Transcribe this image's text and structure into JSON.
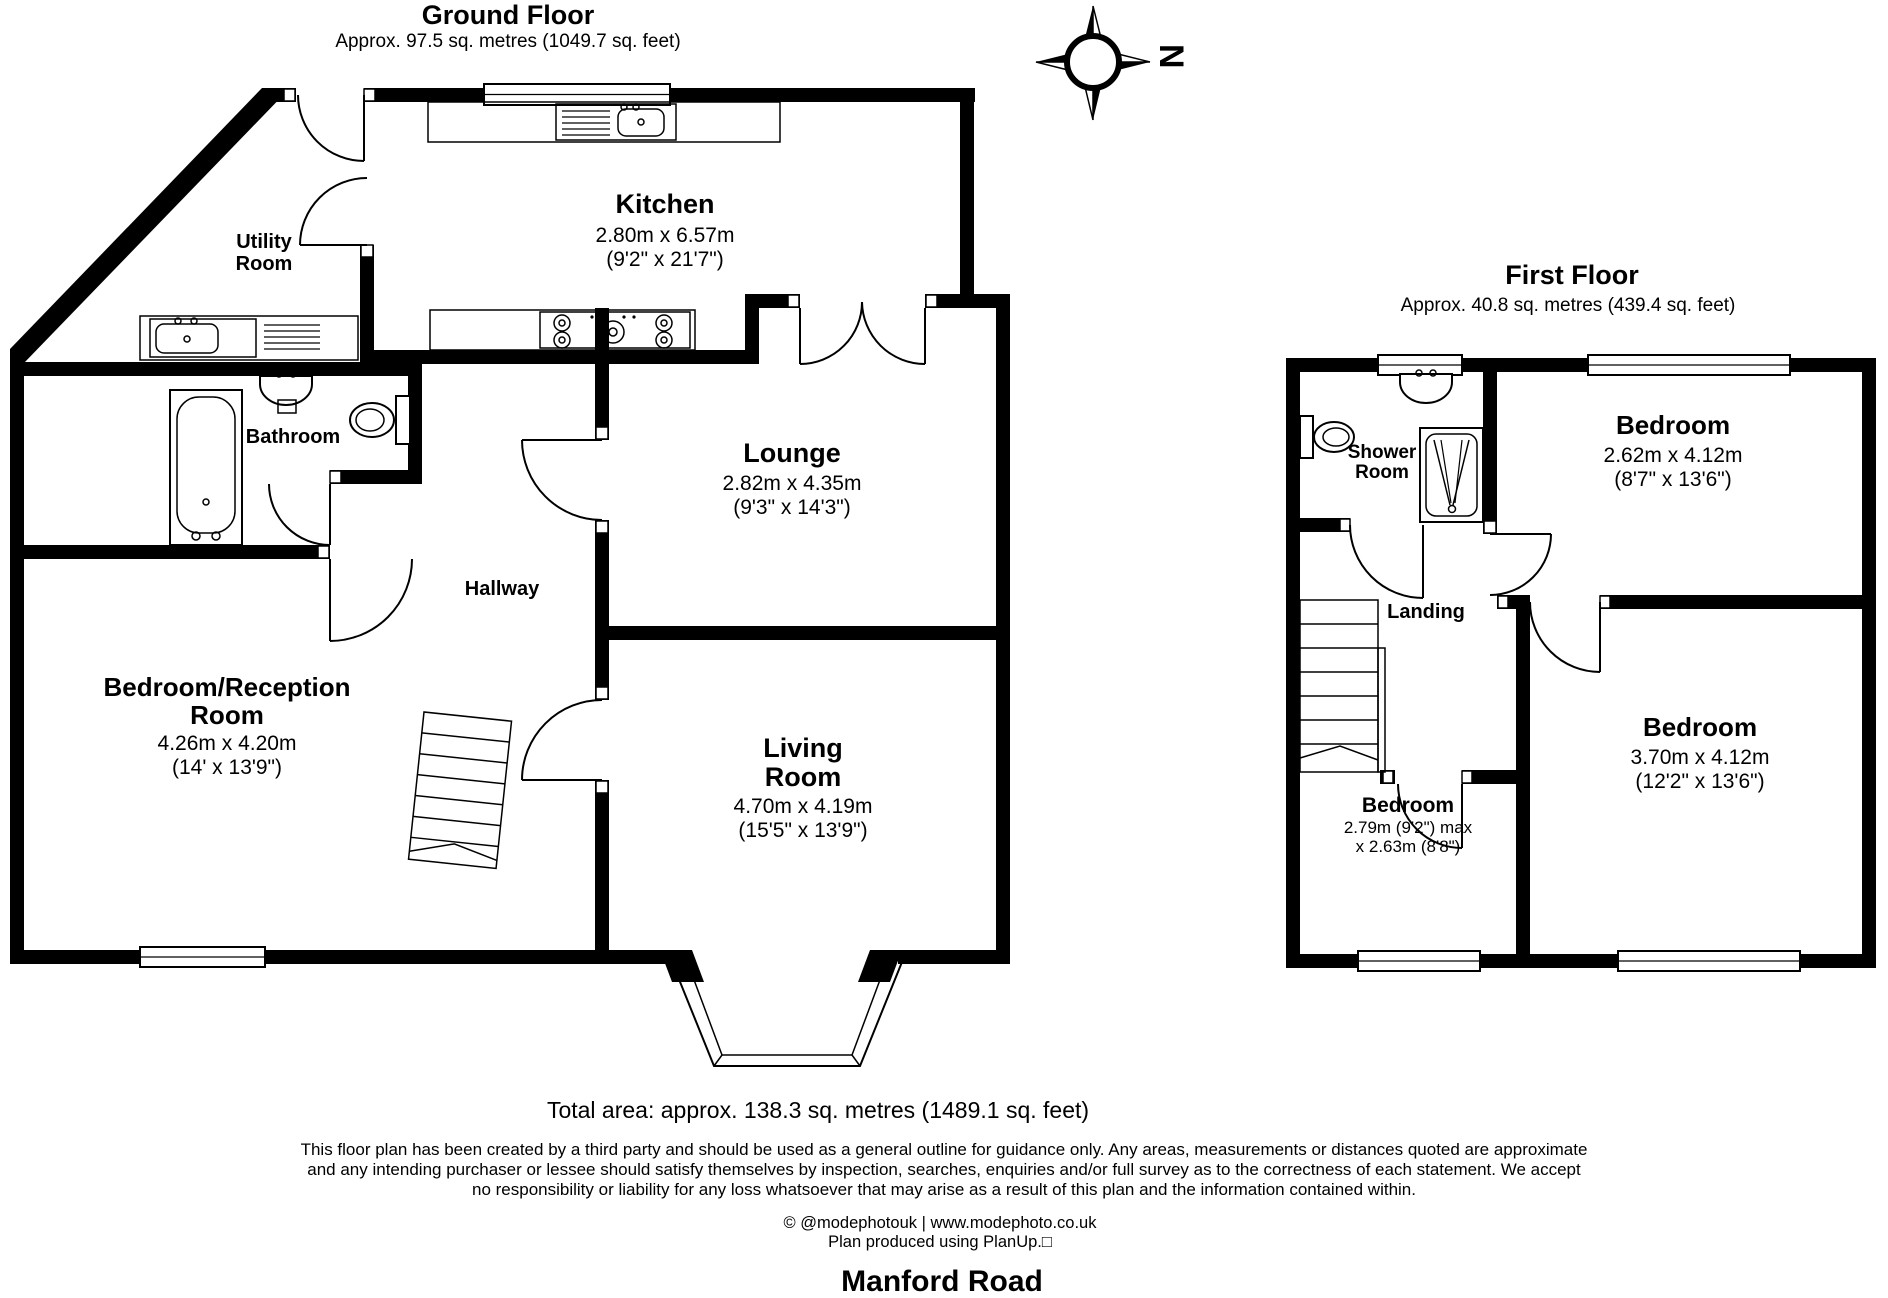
{
  "ground_floor": {
    "title": "Ground Floor",
    "subtitle": "Approx. 97.5 sq. metres (1049.7 sq. feet)",
    "rooms": {
      "kitchen": {
        "name": "Kitchen",
        "metric": "2.80m x 6.57m",
        "imperial": "(9'2\" x 21'7\")"
      },
      "utility": {
        "line1": "Utility",
        "line2": "Room"
      },
      "bathroom": {
        "name": "Bathroom"
      },
      "hallway": {
        "name": "Hallway"
      },
      "lounge": {
        "name": "Lounge",
        "metric": "2.82m x 4.35m",
        "imperial": "(9'3\" x 14'3\")"
      },
      "bedroom_reception": {
        "line1": "Bedroom/Reception",
        "line2": "Room",
        "metric": "4.26m x 4.20m",
        "imperial": "(14' x 13'9\")"
      },
      "living_room": {
        "line1": "Living",
        "line2": "Room",
        "metric": "4.70m x 4.19m",
        "imperial": "(15'5\" x 13'9\")"
      }
    }
  },
  "first_floor": {
    "title": "First Floor",
    "subtitle": "Approx. 40.8 sq. metres (439.4 sq. feet)",
    "rooms": {
      "shower_room": {
        "line1": "Shower",
        "line2": "Room"
      },
      "landing": {
        "name": "Landing"
      },
      "bedroom_front": {
        "name": "Bedroom",
        "metric": "2.62m x 4.12m",
        "imperial": "(8'7\" x 13'6\")"
      },
      "bedroom_small": {
        "name": "Bedroom",
        "dims1": "2.79m (9'2\") max",
        "dims2": "x 2.63m (8'8\")"
      },
      "bedroom_rear": {
        "name": "Bedroom",
        "metric": "3.70m x 4.12m",
        "imperial": "(12'2\" x 13'6\")"
      }
    }
  },
  "compass": {
    "north_label": "N"
  },
  "footer": {
    "total_area": "Total area: approx. 138.3 sq. metres (1489.1 sq. feet)",
    "disclaimer_line1": "This floor plan has been created by a third party and should be used as a general outline for guidance only. Any areas, measurements or distances quoted are approximate",
    "disclaimer_line2": "and any intending purchaser or lessee should satisfy themselves by inspection, searches, enquiries and/or full survey as to the correctness of each statement. We accept",
    "disclaimer_line3": "no responsibility or liability for any loss whatsoever that may arise as a result of this plan and the information contained within.",
    "credit": "© @modephotouk | www.modephoto.co.uk",
    "produced": "Plan produced using PlanUp.□",
    "address": "Manford Road"
  },
  "colors": {
    "ink": "#000000",
    "paper": "#ffffff"
  }
}
